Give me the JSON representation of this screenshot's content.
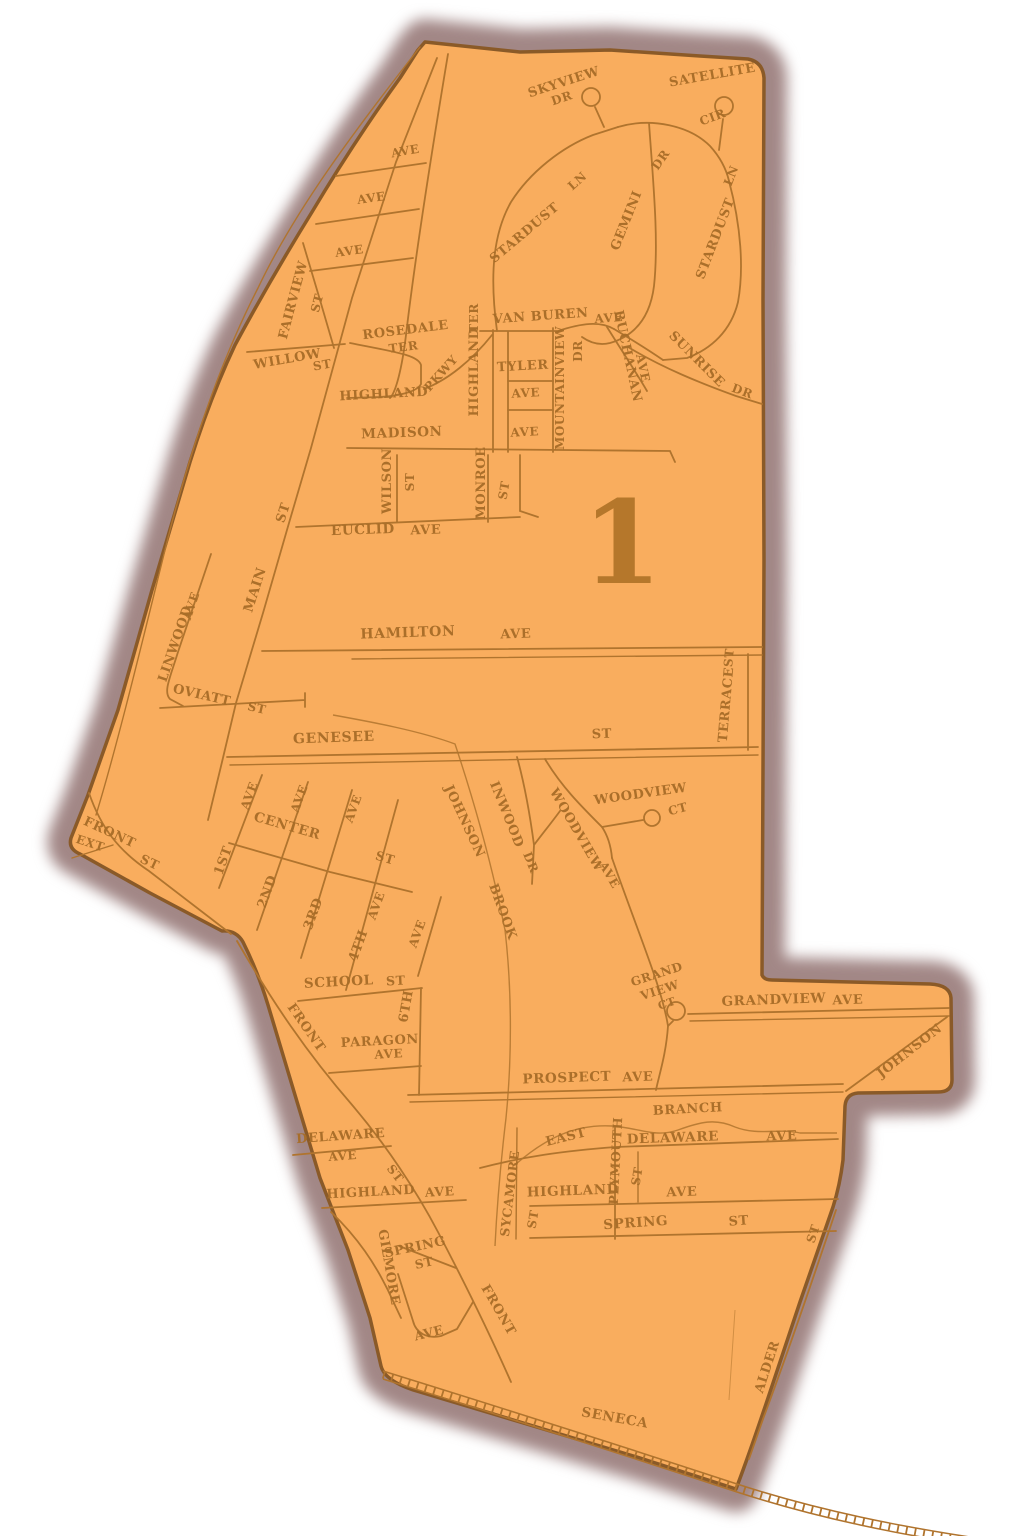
{
  "district": {
    "number": "1"
  },
  "colors": {
    "map_fill": "#f9ad5e",
    "map_border": "#8a5a28",
    "shadow": "#a28786",
    "road": "#b0742e",
    "label": "#a86d28",
    "district_number": "#b5772b"
  },
  "district_number_pos": {
    "x": 622,
    "y": 583,
    "size": 115
  },
  "labels": [
    {
      "t": "SKYVIEW",
      "x": 565,
      "y": 86,
      "r": -18,
      "s": 13
    },
    {
      "t": "DR",
      "x": 563,
      "y": 102,
      "r": -18,
      "s": 12
    },
    {
      "t": "SATELLITE",
      "x": 713,
      "y": 79,
      "r": -10,
      "s": 13
    },
    {
      "t": "CIR",
      "x": 714,
      "y": 121,
      "r": -20,
      "s": 12
    },
    {
      "t": "STARDUST",
      "x": 527,
      "y": 236,
      "r": -40,
      "s": 13
    },
    {
      "t": "LN",
      "x": 580,
      "y": 184,
      "r": -42,
      "s": 12
    },
    {
      "t": "GEMINI",
      "x": 630,
      "y": 222,
      "r": -68,
      "s": 13
    },
    {
      "t": "DR",
      "x": 664,
      "y": 162,
      "r": -55,
      "s": 12
    },
    {
      "t": "STARDUST",
      "x": 719,
      "y": 240,
      "r": -69,
      "s": 13
    },
    {
      "t": "LN",
      "x": 735,
      "y": 177,
      "r": -69,
      "s": 12
    },
    {
      "t": "VAN BUREN",
      "x": 541,
      "y": 320,
      "r": -4,
      "s": 13
    },
    {
      "t": "AVE",
      "x": 609,
      "y": 322,
      "r": -4,
      "s": 12
    },
    {
      "t": "AVE",
      "x": 406,
      "y": 155,
      "r": -10,
      "s": 12
    },
    {
      "t": "AVE",
      "x": 372,
      "y": 202,
      "r": -8,
      "s": 12
    },
    {
      "t": "AVE",
      "x": 350,
      "y": 255,
      "r": -8,
      "s": 12
    },
    {
      "t": "FAIRVIEW",
      "x": 297,
      "y": 301,
      "r": -75,
      "s": 13
    },
    {
      "t": "ST",
      "x": 321,
      "y": 304,
      "r": -75,
      "s": 12
    },
    {
      "t": "WILLOW",
      "x": 288,
      "y": 363,
      "r": -10,
      "s": 13
    },
    {
      "t": "ST",
      "x": 323,
      "y": 369,
      "r": -10,
      "s": 12
    },
    {
      "t": "ROSEDALE",
      "x": 406,
      "y": 334,
      "r": -7,
      "s": 13
    },
    {
      "t": "TER",
      "x": 404,
      "y": 351,
      "r": -7,
      "s": 12
    },
    {
      "t": "HIGHLAND",
      "x": 384,
      "y": 398,
      "r": -3,
      "s": 13
    },
    {
      "t": "PKWY",
      "x": 444,
      "y": 376,
      "r": -48,
      "s": 12
    },
    {
      "t": "HIGHLAND",
      "x": 478,
      "y": 372,
      "r": -90,
      "s": 13
    },
    {
      "t": "TER",
      "x": 478,
      "y": 318,
      "r": -90,
      "s": 12
    },
    {
      "t": "TYLER",
      "x": 523,
      "y": 370,
      "r": -3,
      "s": 13
    },
    {
      "t": "AVE",
      "x": 526,
      "y": 397,
      "r": -3,
      "s": 12
    },
    {
      "t": "AVE",
      "x": 525,
      "y": 436,
      "r": -3,
      "s": 12
    },
    {
      "t": "MOUNTAINVIEW",
      "x": 564,
      "y": 388,
      "r": -90,
      "s": 12
    },
    {
      "t": "DR",
      "x": 582,
      "y": 351,
      "r": -90,
      "s": 12
    },
    {
      "t": "BUCHANAN",
      "x": 624,
      "y": 357,
      "r": 78,
      "s": 13
    },
    {
      "t": "AVE",
      "x": 639,
      "y": 369,
      "r": 78,
      "s": 12
    },
    {
      "t": "SUNRISE",
      "x": 694,
      "y": 362,
      "r": 45,
      "s": 13
    },
    {
      "t": "DR",
      "x": 741,
      "y": 395,
      "r": 20,
      "s": 12
    },
    {
      "t": "MADISON",
      "x": 402,
      "y": 437,
      "r": -2,
      "s": 13.5
    },
    {
      "t": "WILSON",
      "x": 391,
      "y": 481,
      "r": -90,
      "s": 13
    },
    {
      "t": "ST",
      "x": 414,
      "y": 482,
      "r": -90,
      "s": 12
    },
    {
      "t": "MONROE",
      "x": 485,
      "y": 483,
      "r": -90,
      "s": 13
    },
    {
      "t": "ST",
      "x": 508,
      "y": 491,
      "r": -80,
      "s": 12
    },
    {
      "t": "EUCLID",
      "x": 363,
      "y": 534,
      "r": -2,
      "s": 13.5
    },
    {
      "t": "AVE",
      "x": 426,
      "y": 534,
      "r": -2,
      "s": 13
    },
    {
      "t": "MAIN",
      "x": 259,
      "y": 591,
      "r": -72,
      "s": 13.5
    },
    {
      "t": "ST",
      "x": 287,
      "y": 514,
      "r": -72,
      "s": 13
    },
    {
      "t": "LINWOOD",
      "x": 179,
      "y": 645,
      "r": -71,
      "s": 13
    },
    {
      "t": "AVE",
      "x": 195,
      "y": 607,
      "r": -71,
      "s": 12
    },
    {
      "t": "HAMILTON",
      "x": 408,
      "y": 637,
      "r": -2,
      "s": 14
    },
    {
      "t": "AVE",
      "x": 516,
      "y": 638,
      "r": -2,
      "s": 13
    },
    {
      "t": "OVIATT",
      "x": 201,
      "y": 699,
      "r": 13,
      "s": 13
    },
    {
      "t": "ST",
      "x": 256,
      "y": 712,
      "r": 13,
      "s": 12
    },
    {
      "t": "GENESEE",
      "x": 334,
      "y": 742,
      "r": -2,
      "s": 14
    },
    {
      "t": "ST",
      "x": 602,
      "y": 738,
      "r": -2,
      "s": 13
    },
    {
      "t": "TERRACE",
      "x": 730,
      "y": 705,
      "r": -85,
      "s": 13
    },
    {
      "t": "ST",
      "x": 733,
      "y": 658,
      "r": -85,
      "s": 12
    },
    {
      "t": "WOODVIEW",
      "x": 641,
      "y": 798,
      "r": -8,
      "s": 13
    },
    {
      "t": "CT",
      "x": 679,
      "y": 813,
      "r": -15,
      "s": 12
    },
    {
      "t": "WOODVIEW",
      "x": 573,
      "y": 832,
      "r": 60,
      "s": 13
    },
    {
      "t": "AVE",
      "x": 606,
      "y": 877,
      "r": 60,
      "s": 12
    },
    {
      "t": "INWOOD",
      "x": 503,
      "y": 816,
      "r": 68,
      "s": 13
    },
    {
      "t": "DR",
      "x": 527,
      "y": 864,
      "r": 68,
      "s": 12
    },
    {
      "t": "JOHNSON",
      "x": 461,
      "y": 823,
      "r": 65,
      "s": 13
    },
    {
      "t": "BROOK",
      "x": 499,
      "y": 913,
      "r": 70,
      "s": 13
    },
    {
      "t": "CENTER",
      "x": 286,
      "y": 830,
      "r": 16,
      "s": 13.5
    },
    {
      "t": "ST",
      "x": 384,
      "y": 862,
      "r": 16,
      "s": 12.5
    },
    {
      "t": "AVE",
      "x": 253,
      "y": 797,
      "r": -70,
      "s": 12
    },
    {
      "t": "AVE",
      "x": 303,
      "y": 800,
      "r": -70,
      "s": 12
    },
    {
      "t": "AVE",
      "x": 357,
      "y": 810,
      "r": -70,
      "s": 12
    },
    {
      "t": "1ST",
      "x": 227,
      "y": 862,
      "r": -70,
      "s": 13
    },
    {
      "t": "2ND",
      "x": 271,
      "y": 893,
      "r": -70,
      "s": 13
    },
    {
      "t": "3RD",
      "x": 317,
      "y": 915,
      "r": -70,
      "s": 13
    },
    {
      "t": "4TH",
      "x": 362,
      "y": 947,
      "r": -70,
      "s": 13
    },
    {
      "t": "AVE",
      "x": 380,
      "y": 907,
      "r": -70,
      "s": 12
    },
    {
      "t": "AVE",
      "x": 421,
      "y": 935,
      "r": -70,
      "s": 12
    },
    {
      "t": "6TH",
      "x": 410,
      "y": 1007,
      "r": -80,
      "s": 13
    },
    {
      "t": "SCHOOL",
      "x": 339,
      "y": 986,
      "r": -3,
      "s": 13.5
    },
    {
      "t": "ST",
      "x": 396,
      "y": 985,
      "r": -3,
      "s": 12.5
    },
    {
      "t": "FRONT",
      "x": 303,
      "y": 1030,
      "r": 55,
      "s": 13
    },
    {
      "t": "PARAGON",
      "x": 380,
      "y": 1045,
      "r": -3,
      "s": 13
    },
    {
      "t": "AVE",
      "x": 389,
      "y": 1058,
      "r": -3,
      "s": 12
    },
    {
      "t": "GRAND",
      "x": 658,
      "y": 978,
      "r": -18,
      "s": 12
    },
    {
      "t": "VIEW",
      "x": 661,
      "y": 994,
      "r": -18,
      "s": 12
    },
    {
      "t": "CT",
      "x": 668,
      "y": 1007,
      "r": -18,
      "s": 11
    },
    {
      "t": "GRANDVIEW",
      "x": 774,
      "y": 1004,
      "r": -2,
      "s": 13.5
    },
    {
      "t": "AVE",
      "x": 848,
      "y": 1004,
      "r": -2,
      "s": 13
    },
    {
      "t": "JOHNSON",
      "x": 912,
      "y": 1054,
      "r": -38,
      "s": 13
    },
    {
      "t": "PROSPECT",
      "x": 567,
      "y": 1082,
      "r": -2,
      "s": 13.5
    },
    {
      "t": "AVE",
      "x": 638,
      "y": 1081,
      "r": -2,
      "s": 13
    },
    {
      "t": "BRANCH",
      "x": 688,
      "y": 1113,
      "r": -3,
      "s": 13
    },
    {
      "t": "EAST",
      "x": 567,
      "y": 1141,
      "r": -14,
      "s": 13
    },
    {
      "t": "DELAWARE",
      "x": 673,
      "y": 1142,
      "r": -2,
      "s": 13.5
    },
    {
      "t": "AVE",
      "x": 782,
      "y": 1140,
      "r": -2,
      "s": 13
    },
    {
      "t": "PLYMOUTH",
      "x": 620,
      "y": 1161,
      "r": -87,
      "s": 12.5
    },
    {
      "t": "ST",
      "x": 641,
      "y": 1177,
      "r": -80,
      "s": 12
    },
    {
      "t": "SYCAMORE",
      "x": 514,
      "y": 1194,
      "r": -83,
      "s": 12.5
    },
    {
      "t": "ST",
      "x": 537,
      "y": 1220,
      "r": -80,
      "s": 12
    },
    {
      "t": "HIGHLAND",
      "x": 573,
      "y": 1195,
      "r": -2,
      "s": 13.5
    },
    {
      "t": "AVE",
      "x": 682,
      "y": 1196,
      "r": -2,
      "s": 13
    },
    {
      "t": "SPRING",
      "x": 636,
      "y": 1227,
      "r": -4,
      "s": 13.5
    },
    {
      "t": "ST",
      "x": 739,
      "y": 1225,
      "r": -4,
      "s": 13
    },
    {
      "t": "DELAWARE",
      "x": 341,
      "y": 1140,
      "r": -4,
      "s": 13
    },
    {
      "t": "AVE",
      "x": 343,
      "y": 1160,
      "r": -4,
      "s": 12
    },
    {
      "t": "ST",
      "x": 392,
      "y": 1176,
      "r": 52,
      "s": 12
    },
    {
      "t": "HIGHLAND",
      "x": 371,
      "y": 1196,
      "r": -3,
      "s": 13
    },
    {
      "t": "AVE",
      "x": 440,
      "y": 1196,
      "r": -3,
      "s": 12.5
    },
    {
      "t": "GILMORE",
      "x": 385,
      "y": 1268,
      "r": 80,
      "s": 13
    },
    {
      "t": "SPRING",
      "x": 416,
      "y": 1251,
      "r": -12,
      "s": 13
    },
    {
      "t": "ST",
      "x": 425,
      "y": 1267,
      "r": -12,
      "s": 12
    },
    {
      "t": "FRONT",
      "x": 495,
      "y": 1312,
      "r": 60,
      "s": 13
    },
    {
      "t": "AVE",
      "x": 430,
      "y": 1337,
      "r": -14,
      "s": 12.5
    },
    {
      "t": "SENECA",
      "x": 614,
      "y": 1422,
      "r": 10,
      "s": 13.5
    },
    {
      "t": "ALDER",
      "x": 771,
      "y": 1368,
      "r": -72,
      "s": 13
    },
    {
      "t": "ST",
      "x": 817,
      "y": 1235,
      "r": -72,
      "s": 12
    },
    {
      "t": "FRONT",
      "x": 108,
      "y": 836,
      "r": 25,
      "s": 13
    },
    {
      "t": "EXT",
      "x": 89,
      "y": 847,
      "r": 18,
      "s": 12
    },
    {
      "t": "ST",
      "x": 148,
      "y": 866,
      "r": 25,
      "s": 12.5
    }
  ]
}
